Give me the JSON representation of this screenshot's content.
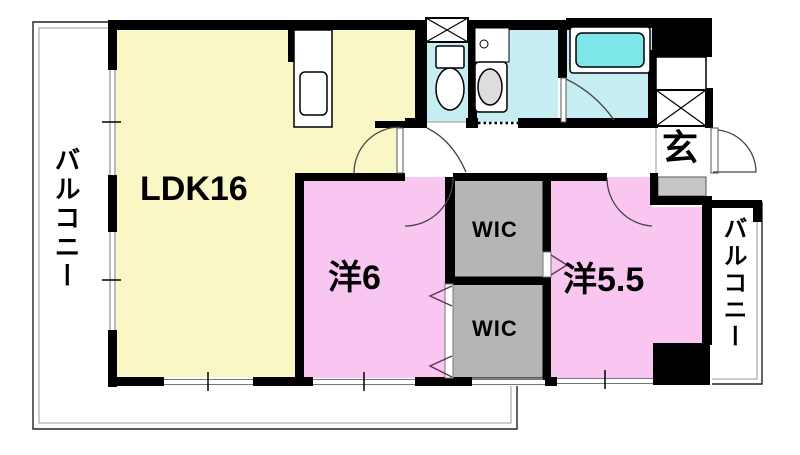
{
  "plan": {
    "type": "apartment-floor-plan",
    "rooms": {
      "ldk": {
        "label": "LDK16",
        "color": "#FAF7C6"
      },
      "western_6": {
        "label": "洋6",
        "color": "#F8C6F0"
      },
      "western_55": {
        "label": "洋5.5",
        "color": "#F8C6F0"
      },
      "wic_upper": {
        "label": "WIC",
        "color": "#B5B5B5"
      },
      "wic_lower": {
        "label": "WIC",
        "color": "#B5B5B5"
      },
      "genkan": {
        "label": "玄"
      },
      "balcony_left": {
        "label": "バルコニー"
      },
      "balcony_right": {
        "label": "バルコニー"
      }
    },
    "colors": {
      "wet_area": "#C6EEF2",
      "bathtub": "#7EE7EA",
      "wall": "#000000",
      "shoe_cabinet": "#C6C6C6",
      "door_arc": "#444444",
      "chevron": "#663355"
    }
  }
}
